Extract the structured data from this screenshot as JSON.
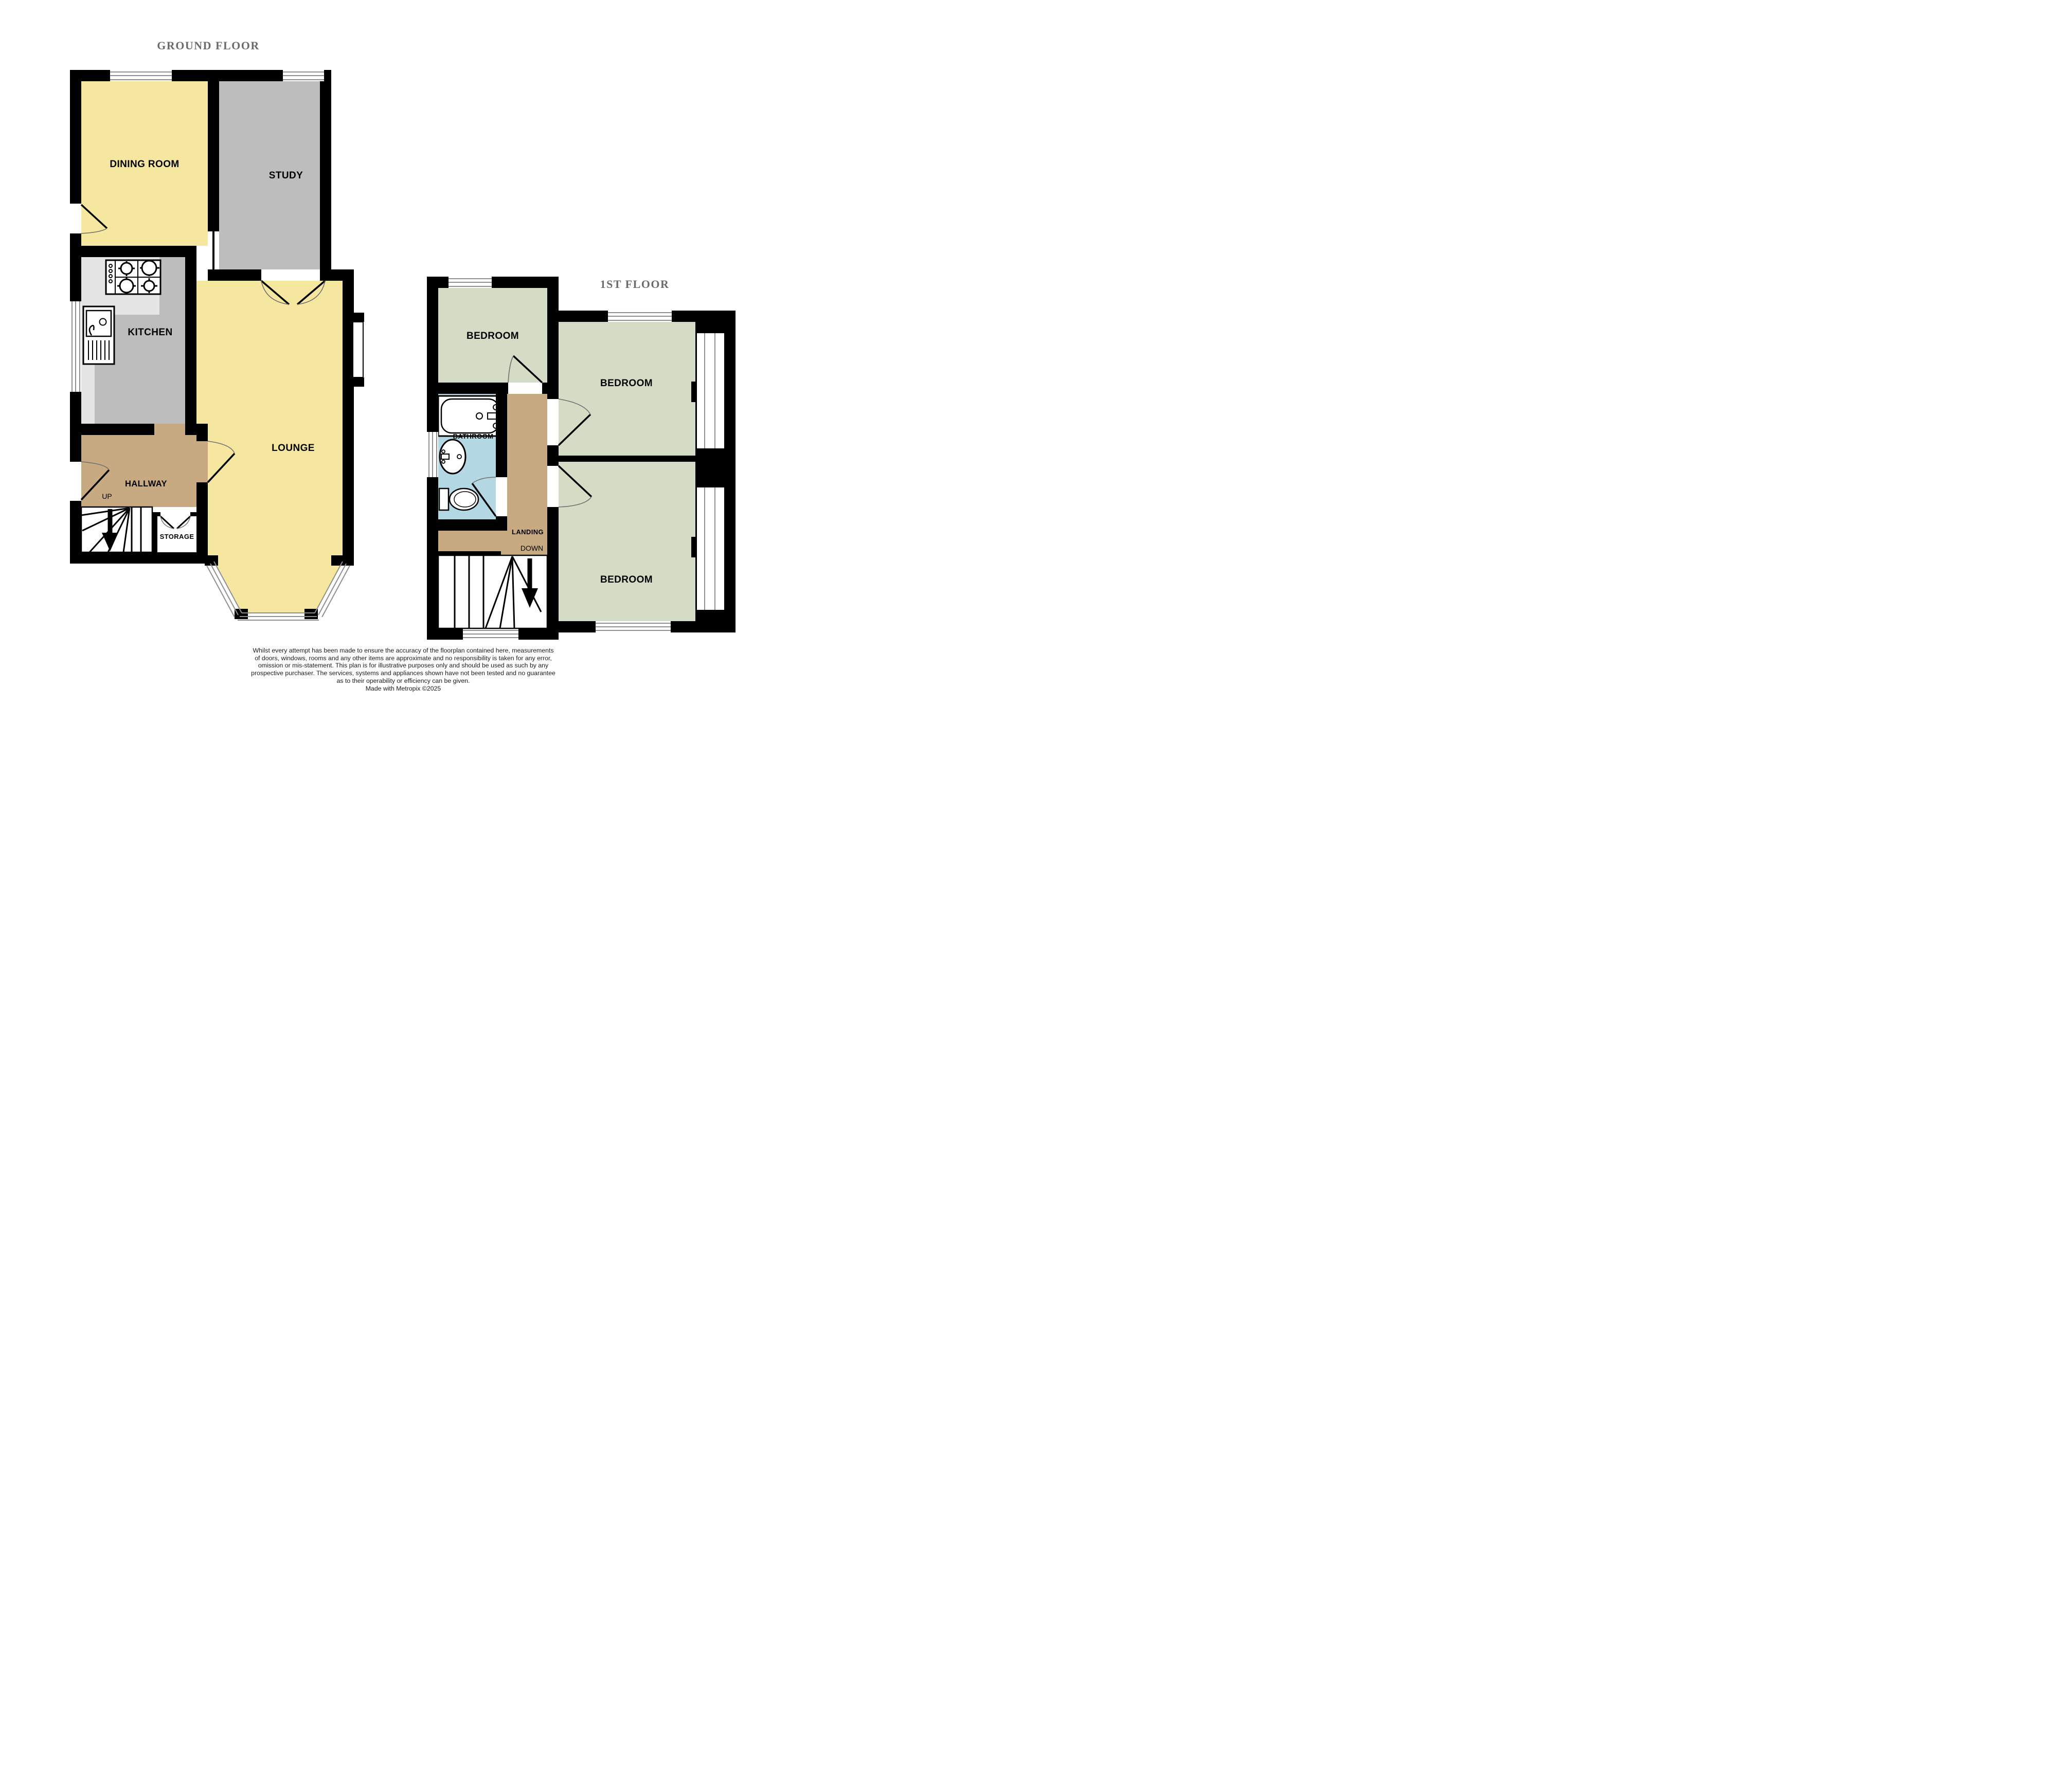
{
  "page": {
    "background": "#FFFFFF"
  },
  "colors": {
    "wall": "#000000",
    "window_line": "#8F8F8F",
    "door_arc": "#6E6E6E",
    "title_text": "#6B6B6B",
    "label_text": "#000000",
    "room_yellow": "#F6E7A0",
    "room_gray": "#BDBDBD",
    "kitchen_counter": "#E5E5E5",
    "room_tan": "#C8AA82",
    "room_green": "#D4DCC6",
    "room_blue": "#B3D7E3",
    "room_white": "#FFFFFF"
  },
  "icons": {
    "stove": "stove-icon",
    "sink": "sink-icon",
    "bathtub": "bathtub-icon",
    "washbasin": "washbasin-icon",
    "toilet": "toilet-icon",
    "up_arrow": "up-arrow-icon",
    "down_arrow": "down-arrow-icon"
  },
  "ground_floor": {
    "title": "GROUND FLOOR",
    "rooms": {
      "dining_room": {
        "label": "DINING ROOM",
        "color": "#F6E7A0"
      },
      "study": {
        "label": "STUDY",
        "color": "#BDBDBD"
      },
      "kitchen": {
        "label": "KITCHEN",
        "color": "#BDBDBD"
      },
      "lounge": {
        "label": "LOUNGE",
        "color": "#F6E7A0"
      },
      "hallway": {
        "label": "HALLWAY",
        "color": "#C8AA82"
      },
      "storage": {
        "label": "STORAGE",
        "color": "#FFFFFF"
      }
    },
    "stairs": {
      "direction_label": "UP"
    }
  },
  "first_floor": {
    "title": "1ST FLOOR",
    "rooms": {
      "bedroom_top_left": {
        "label": "BEDROOM",
        "color": "#D4DCC6"
      },
      "bedroom_right_top": {
        "label": "BEDROOM",
        "color": "#D4DCC6"
      },
      "bedroom_right_bottom": {
        "label": "BEDROOM",
        "color": "#D4DCC6"
      },
      "bathroom": {
        "label": "BATHROOM",
        "color": "#B3D7E3"
      },
      "landing": {
        "label": "LANDING",
        "color": "#C8AA82"
      }
    },
    "stairs": {
      "direction_label": "DOWN"
    }
  },
  "disclaimer": {
    "lines": [
      "Whilst every attempt has been made to ensure the accuracy of the floorplan contained here, measurements",
      "of doors, windows, rooms and any other items are approximate and no responsibility is taken for any error,",
      "omission or mis-statement. This plan is for illustrative purposes only and should be used as such by any",
      "prospective purchaser. The services, systems and appliances shown have not been tested and no guarantee",
      "as to their operability or efficiency can be given.",
      "Made with Metropix ©2025"
    ]
  }
}
